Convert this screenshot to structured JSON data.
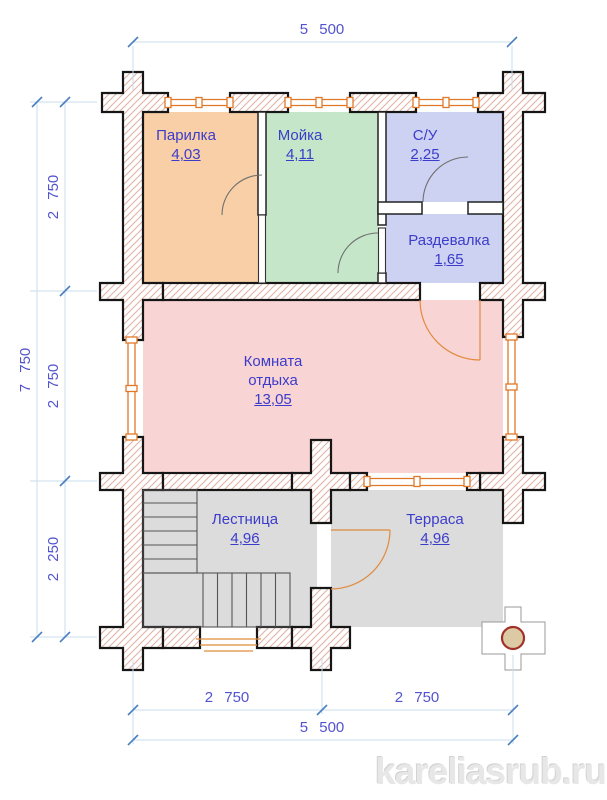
{
  "plan": {
    "rooms": [
      {
        "name": "Парилка",
        "area": "4,03",
        "color": "#f8cfa6"
      },
      {
        "name": "Мойка",
        "area": "4,11",
        "color": "#c5e6c8"
      },
      {
        "name": "С/У",
        "area": "2,25",
        "color": "#cdd2f2"
      },
      {
        "name": "Раздевалка",
        "area": "1,65",
        "color": "#cdd2f2"
      },
      {
        "name": "Комната отдыха",
        "area": "13,05",
        "color": "#f9d4d4"
      },
      {
        "name": "Лестница",
        "area": "4,96",
        "color": "#dcdcdc"
      },
      {
        "name": "Терраса",
        "area": "4,96",
        "color": "#dcdcdc"
      }
    ],
    "dimensions": {
      "top_total": "5 500",
      "left_total": "7 750",
      "left_segments": [
        "2 750",
        "2 750",
        "2 250"
      ],
      "bottom_segments": [
        "2 750",
        "2 750"
      ],
      "bottom_total": "5 500"
    },
    "watermark": "kareliasrub.ru",
    "colors": {
      "wall_hatch": "#e2b3a6",
      "wall_outline": "#161616",
      "window": "#e07828",
      "door_interior": "#707070",
      "door_exterior": "#e08a3c",
      "dimension_line": "#c9dcec",
      "dimension_tick": "#4a7fc1",
      "dimension_text": "#5353cf",
      "room_label_text": "#3c3ccb",
      "column_circle_fill": "#dbcaa4",
      "column_circle_stroke": "#a23028",
      "watermark_color": "#e7e7e7"
    }
  }
}
